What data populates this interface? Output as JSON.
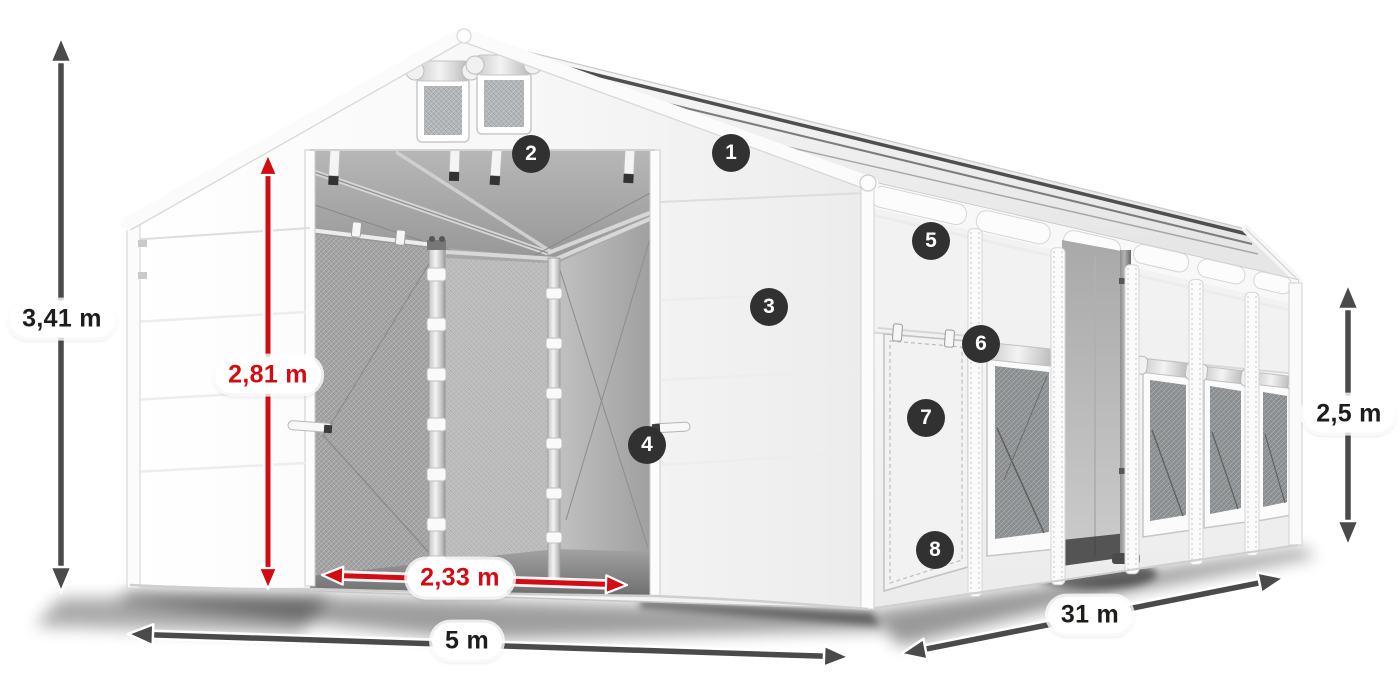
{
  "colors": {
    "dimension_dark": "#4a4a4a",
    "dimension_red": "#d20c12",
    "badge_bg": "#313131",
    "badge_text": "#ffffff",
    "label_bg": "#ffffff",
    "label_text_dark": "#1d1d1b"
  },
  "dimensions": {
    "total_height": {
      "label": "3,41 m",
      "style": "dark"
    },
    "door_height": {
      "label": "2,81 m",
      "style": "red"
    },
    "door_width": {
      "label": "2,33 m",
      "style": "red"
    },
    "width": {
      "label": "5 m",
      "style": "dark"
    },
    "length": {
      "label": "31 m",
      "style": "dark"
    },
    "side_height": {
      "label": "2,5 m",
      "style": "dark"
    }
  },
  "markers": [
    {
      "number": "1"
    },
    {
      "number": "2"
    },
    {
      "number": "3"
    },
    {
      "number": "4"
    },
    {
      "number": "5"
    },
    {
      "number": "6"
    },
    {
      "number": "7"
    },
    {
      "number": "8"
    }
  ]
}
